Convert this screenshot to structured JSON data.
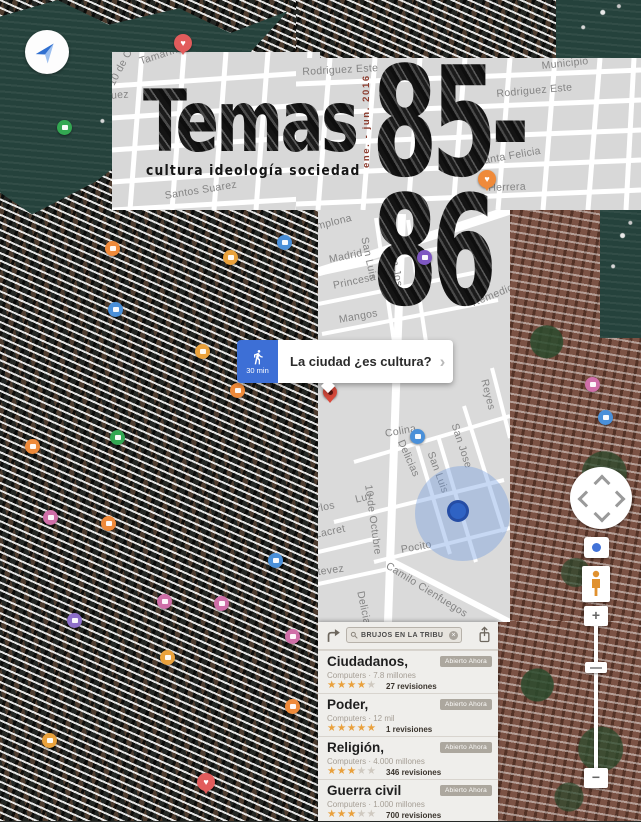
{
  "masthead": {
    "title": "Temas",
    "subtitle": "cultura ideología sociedad",
    "issue": "85-86",
    "date": "ene. - jun. 2016"
  },
  "route_bubble": {
    "duration": "30 min",
    "question": "La ciudad ¿es cultura?",
    "chevron": "›"
  },
  "search": {
    "query": "BRUJOS EN LA TRIBU"
  },
  "results": {
    "items": [
      {
        "title": "Ciudadanos,",
        "subtitle": "Computers · 7.8 millones",
        "stars_full": "★★★★",
        "stars_empty": "★",
        "reviews": "27 revisiones",
        "badge": "Abierto Ahora"
      },
      {
        "title": "Poder,",
        "subtitle": "Computers · 12 mil",
        "stars_full": "★★★★★",
        "stars_empty": "",
        "reviews": "1 revisiones",
        "badge": "Abierto Ahora"
      },
      {
        "title": "Religión,",
        "subtitle": "Computers · 4.000 millones",
        "stars_full": "★★★",
        "stars_empty": "★★",
        "reviews": "346 revisiones",
        "badge": "Abierto Ahora"
      },
      {
        "title": "Guerra civil",
        "subtitle": "Computers · 1.000 millones",
        "stars_full": "★★★",
        "stars_empty": "★★",
        "reviews": "700 revisiones",
        "badge": "Abierto Ahora"
      }
    ]
  },
  "controls": {
    "zoom_in": "+",
    "zoom_out": "−"
  },
  "map": {
    "streets": [
      {
        "layer": "a",
        "label": "Tamarindo",
        "x": 26,
        "y": 4,
        "rot": -18
      },
      {
        "layer": "a",
        "label": "10 de Octubre",
        "x": -6,
        "y": 30,
        "rot": -62
      },
      {
        "layer": "a",
        "label": "Rodriguez",
        "x": -34,
        "y": 40,
        "rot": -4
      },
      {
        "layer": "a",
        "label": "Santos Suarez",
        "x": 52,
        "y": 138,
        "rot": -9
      },
      {
        "layer": "b",
        "label": "Rodriguez Este",
        "x": 6,
        "y": 8,
        "rot": -3
      },
      {
        "layer": "b",
        "label": "Municipio",
        "x": 245,
        "y": 2,
        "rot": -6
      },
      {
        "layer": "b",
        "label": "Rodriguez Este",
        "x": 200,
        "y": 30,
        "rot": -5
      },
      {
        "layer": "b",
        "label": "Perez",
        "x": 200,
        "y": 64,
        "rot": -5
      },
      {
        "layer": "b",
        "label": "Santa Felicia",
        "x": 180,
        "y": 98,
        "rot": -10
      },
      {
        "layer": "b",
        "label": "Herrera",
        "x": 192,
        "y": 124,
        "rot": -2
      },
      {
        "layer": "c",
        "label": "Pamplona",
        "x": -16,
        "y": 14,
        "rot": -14
      },
      {
        "layer": "c",
        "label": "Madrid",
        "x": 10,
        "y": 44,
        "rot": -12
      },
      {
        "layer": "c",
        "label": "San Luis",
        "x": 52,
        "y": 26,
        "rot": 78
      },
      {
        "layer": "c",
        "label": "San Jose",
        "x": 80,
        "y": 36,
        "rot": 80
      },
      {
        "layer": "c",
        "label": "Princesa",
        "x": 14,
        "y": 70,
        "rot": -12
      },
      {
        "layer": "c",
        "label": "Mangos",
        "x": 20,
        "y": 104,
        "rot": -10
      },
      {
        "layer": "c",
        "label": "Remedios",
        "x": 152,
        "y": 88,
        "rot": -22
      },
      {
        "layer": "c",
        "label": "Colina",
        "x": 66,
        "y": 218,
        "rot": -10
      },
      {
        "layer": "c",
        "label": "Delicias",
        "x": 88,
        "y": 228,
        "rot": 66
      },
      {
        "layer": "c",
        "label": "San Luis",
        "x": 118,
        "y": 240,
        "rot": 70
      },
      {
        "layer": "c",
        "label": "San Jose",
        "x": 142,
        "y": 212,
        "rot": 72
      },
      {
        "layer": "c",
        "label": "Reyes",
        "x": 172,
        "y": 168,
        "rot": 76
      },
      {
        "layer": "c",
        "label": "Luz",
        "x": 36,
        "y": 284,
        "rot": -14
      },
      {
        "layer": "c",
        "label": "10 de Octubre",
        "x": 56,
        "y": 274,
        "rot": 82
      },
      {
        "layer": "c",
        "label": "Carlos",
        "x": -16,
        "y": 296,
        "rot": -12
      },
      {
        "layer": "c",
        "label": "General Lacret",
        "x": -46,
        "y": 328,
        "rot": -12
      },
      {
        "layer": "c",
        "label": "Pocito",
        "x": 82,
        "y": 334,
        "rot": -10
      },
      {
        "layer": "c",
        "label": "Estevez",
        "x": -14,
        "y": 358,
        "rot": -8
      },
      {
        "layer": "c",
        "label": "Camilo Cienfuegos",
        "x": 72,
        "y": 350,
        "rot": 32
      },
      {
        "layer": "c",
        "label": "Delicias",
        "x": 48,
        "y": 380,
        "rot": 78
      }
    ],
    "pois": [
      {
        "x": 183,
        "y": 45,
        "icon": "favorite-pin",
        "color": "#e25c5c",
        "shape": "heart"
      },
      {
        "x": 65,
        "y": 128,
        "icon": "lodging-pin",
        "color": "#33a852",
        "shape": "circle"
      },
      {
        "x": 487,
        "y": 181,
        "icon": "favorite-pin",
        "color": "#ef8a3a",
        "shape": "heart"
      },
      {
        "x": 113,
        "y": 249,
        "icon": "restaurant-pin",
        "color": "#ef8a3a",
        "shape": "circle"
      },
      {
        "x": 231,
        "y": 258,
        "icon": "photo-pin",
        "color": "#eaa23c",
        "shape": "circle"
      },
      {
        "x": 285,
        "y": 243,
        "icon": "hotel-pin",
        "color": "#4a90d9",
        "shape": "circle"
      },
      {
        "x": 425,
        "y": 258,
        "icon": "transit-station-pin",
        "color": "#7e57c2",
        "shape": "circle"
      },
      {
        "x": 116,
        "y": 310,
        "icon": "hotel-pin",
        "color": "#4a90d9",
        "shape": "circle"
      },
      {
        "x": 203,
        "y": 352,
        "icon": "photo-pin",
        "color": "#eaa23c",
        "shape": "circle"
      },
      {
        "x": 238,
        "y": 391,
        "icon": "restaurant-pin",
        "color": "#ef8a3a",
        "shape": "circle"
      },
      {
        "x": 418,
        "y": 437,
        "icon": "transit-station-pin",
        "color": "#4a90d9",
        "shape": "circle"
      },
      {
        "x": 33,
        "y": 447,
        "icon": "cafe-pin",
        "color": "#ef8a3a",
        "shape": "circle"
      },
      {
        "x": 118,
        "y": 438,
        "icon": "lodging-pin",
        "color": "#33a852",
        "shape": "circle"
      },
      {
        "x": 51,
        "y": 518,
        "icon": "shopping-pin",
        "color": "#cf6fa8",
        "shape": "circle"
      },
      {
        "x": 109,
        "y": 524,
        "icon": "restaurant-pin",
        "color": "#ef8a3a",
        "shape": "circle"
      },
      {
        "x": 276,
        "y": 561,
        "icon": "hotel-pin",
        "color": "#4a90d9",
        "shape": "circle"
      },
      {
        "x": 165,
        "y": 602,
        "icon": "shopping-pin",
        "color": "#cf6fa8",
        "shape": "circle"
      },
      {
        "x": 222,
        "y": 604,
        "icon": "shopping-pin",
        "color": "#cf6fa8",
        "shape": "circle"
      },
      {
        "x": 75,
        "y": 621,
        "icon": "museum-pin",
        "color": "#8e6fc9",
        "shape": "circle"
      },
      {
        "x": 293,
        "y": 637,
        "icon": "shopping-pin",
        "color": "#cf6fa8",
        "shape": "circle"
      },
      {
        "x": 168,
        "y": 658,
        "icon": "cafe-pin",
        "color": "#eaa23c",
        "shape": "circle"
      },
      {
        "x": 293,
        "y": 707,
        "icon": "restaurant-pin",
        "color": "#ef8a3a",
        "shape": "circle"
      },
      {
        "x": 50,
        "y": 741,
        "icon": "photo-pin",
        "color": "#eaa23c",
        "shape": "circle"
      },
      {
        "x": 206,
        "y": 784,
        "icon": "favorite-pin",
        "color": "#e25c5c",
        "shape": "heart"
      },
      {
        "x": 593,
        "y": 385,
        "icon": "shopping-pin",
        "color": "#cf6fa8",
        "shape": "circle"
      },
      {
        "x": 606,
        "y": 418,
        "icon": "hotel-pin",
        "color": "#4a90d9",
        "shape": "circle"
      },
      {
        "x": 330,
        "y": 394,
        "icon": "destination-pin",
        "color": "#d84a3c",
        "shape": "dot-pin"
      }
    ]
  }
}
